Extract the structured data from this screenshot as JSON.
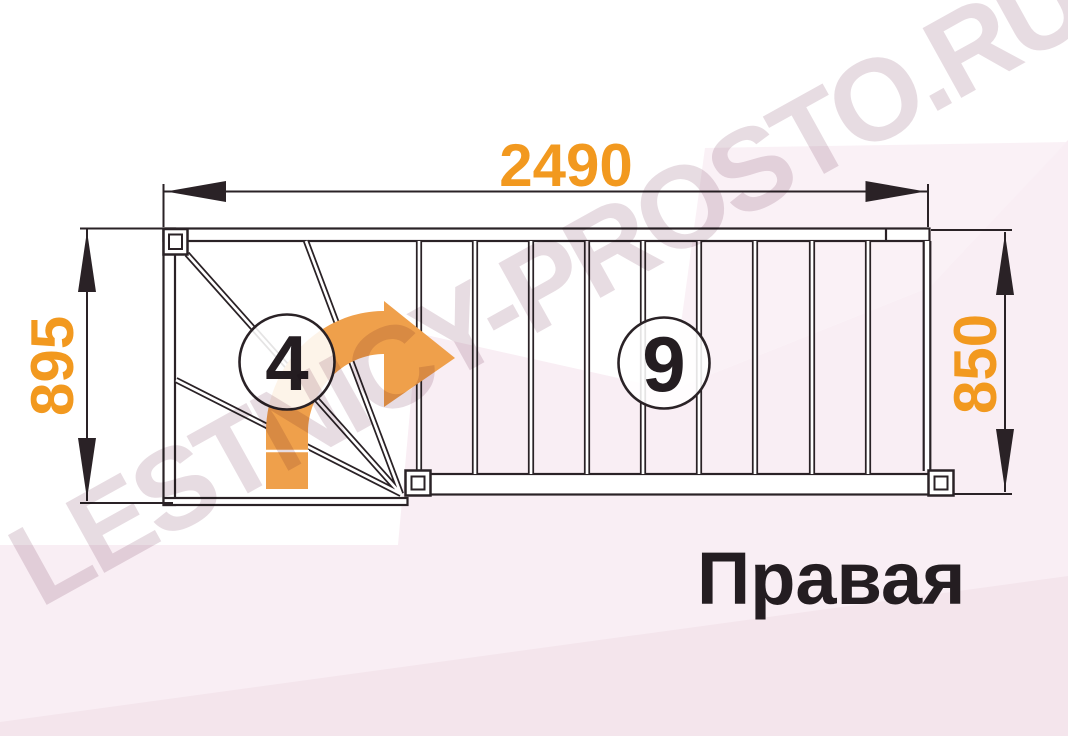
{
  "page": {
    "description": "Staircase floor plan drawing with turn (winder) section and straight flight",
    "orientation_label": "Правая"
  },
  "title": {
    "label": "Правая"
  },
  "watermark": {
    "text": "LESTNICY-PROSTO.RU"
  },
  "dimensions": {
    "top_width": "2490",
    "left_depth": "895",
    "right_width": "850"
  },
  "steps": {
    "winder_count": "4",
    "straight_count": "9"
  },
  "drawing": {
    "type": "stair-plan",
    "turn_direction": "right",
    "winder_treads": 4,
    "straight_treads": 9,
    "newel_posts": 3
  },
  "colors": {
    "dimension_text": "#F2991F",
    "arrow_fill": "#EFA04B",
    "line": "#2A2226",
    "number_text": "#241D21",
    "title_text": "#241D21",
    "background_pink": "#F9EEF4",
    "background_pink_deep": "#F4E5EC",
    "watermark": "#E7DCE2"
  }
}
